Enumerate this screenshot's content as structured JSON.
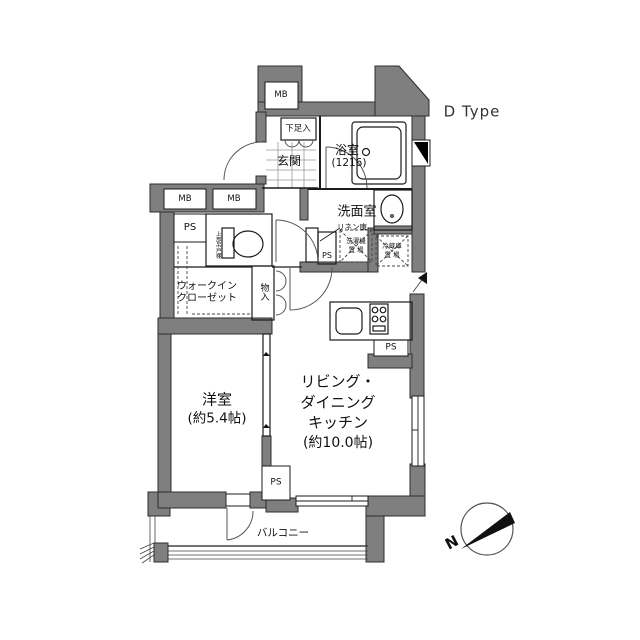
{
  "title": "D Type",
  "compass": {
    "north": "N"
  },
  "labels": {
    "mb": "MB",
    "ps": "PS",
    "shoe_cabinet": "下足入",
    "entrance": "玄関",
    "bathroom": "浴室",
    "bathroom_size": "(1216)",
    "washroom": "洗面室",
    "linen_closet": "リネン庫",
    "washer_line1": "洗濯機",
    "washer_line2": "置 場",
    "fridge_line1": "冷蔵庫",
    "fridge_line2": "置 場",
    "upper_cabinet": "上部吊戸棚",
    "walk_in_closet_line1": "ウォークイン",
    "walk_in_closet_line2": "クローゼット",
    "storage": "物入",
    "western_room": "洋室",
    "western_room_size": "(約5.4帖)",
    "ldk_line1": "リビング・",
    "ldk_line2": "ダイニング",
    "ldk_line3": "キッチン",
    "ldk_size": "(約10.0帖)",
    "balcony": "バルコニー"
  },
  "colors": {
    "wall": "#7f7f7f",
    "line": "#1b1b1b"
  }
}
